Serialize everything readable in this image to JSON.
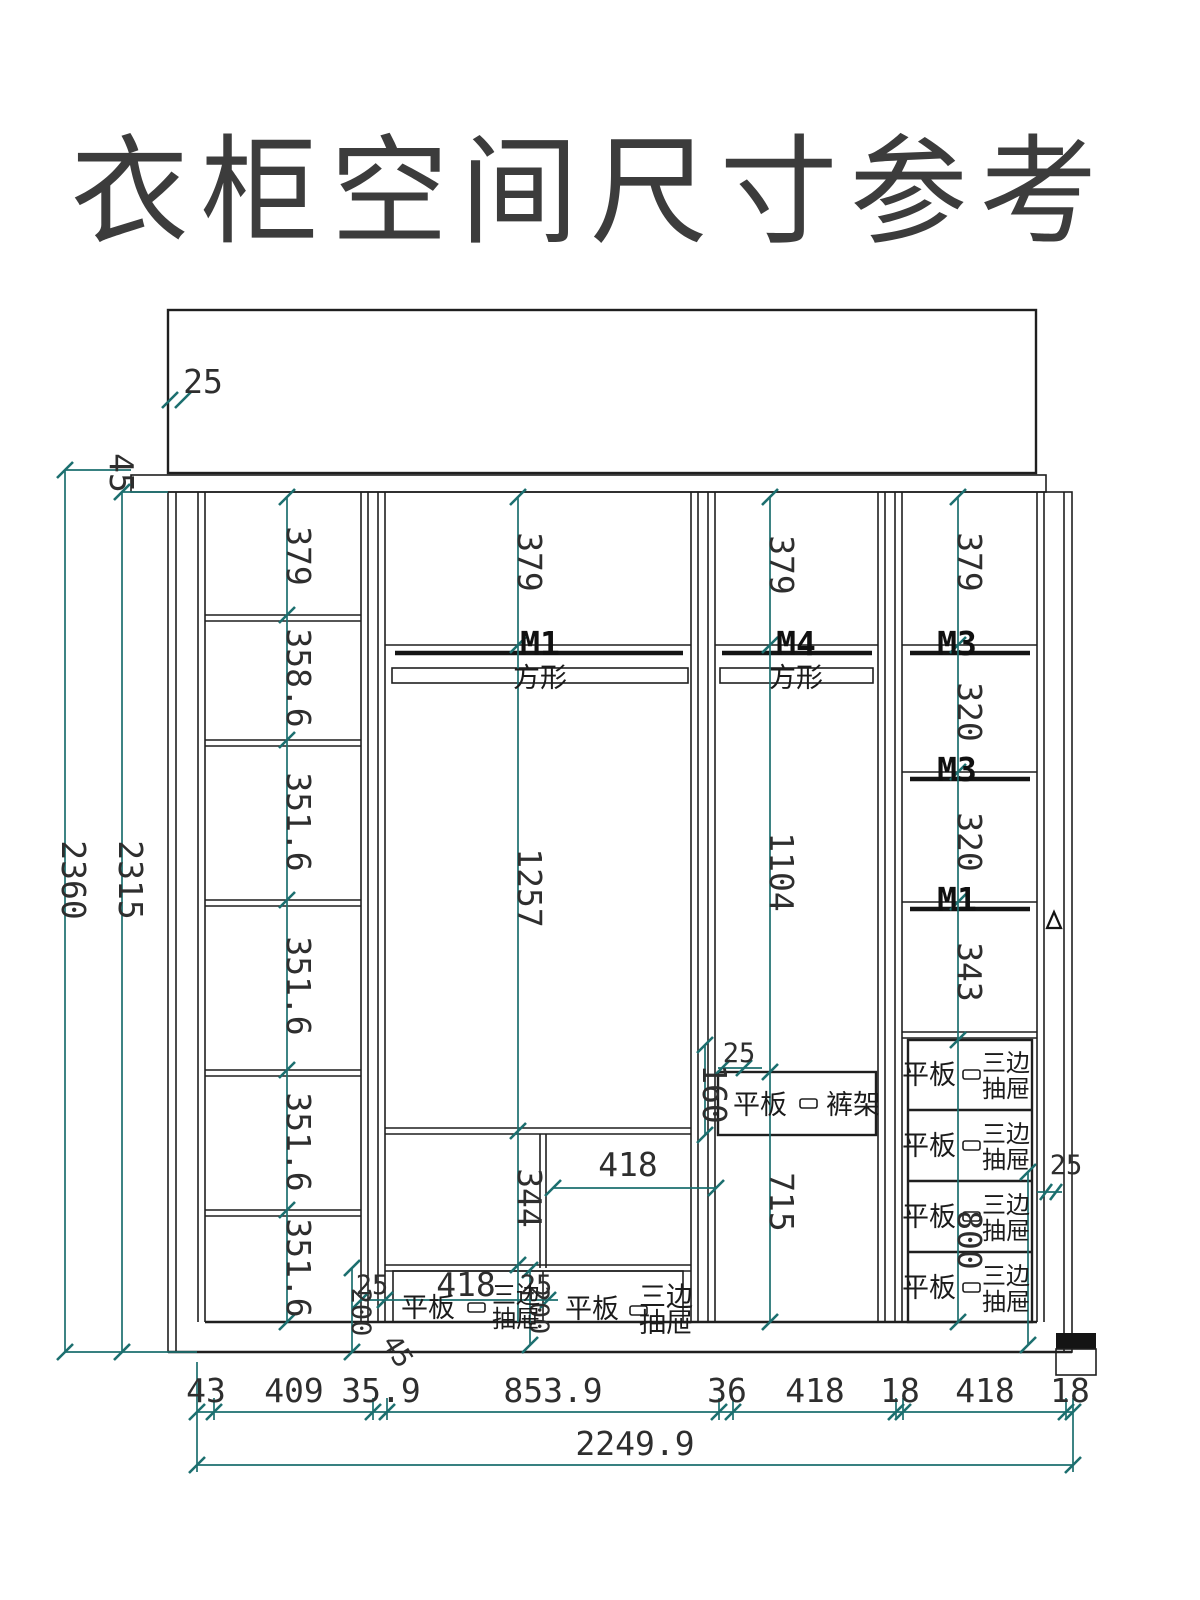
{
  "title": "衣柜空间尺寸参考",
  "labels": {
    "flat_board": "平板",
    "three_side_1": "三边",
    "three_side_2": "抽屉",
    "trouser_rack": "裤架",
    "square_rod": "方形",
    "triangle_marker": "△"
  },
  "m_labels": {
    "col2": "M1",
    "col3": "M4",
    "col4_top": "M3",
    "col4_mid": "M3",
    "col4_low": "M1"
  },
  "dims": {
    "top_thickness": "25",
    "crown_offset": "45",
    "total_height": "2360",
    "body_height": "2315",
    "col1_cells": [
      "379",
      "358.6",
      "351.6",
      "351.6",
      "351.6",
      "351.6"
    ],
    "col2": {
      "top": "379",
      "hang": "1257",
      "lower_left": "344",
      "lower_right_width": "418",
      "d_left": "25",
      "d_width": "418",
      "d_right": "25",
      "d_h1": "200",
      "d_h2": "200",
      "base": "45"
    },
    "col3": {
      "top": "379",
      "hang": "1104",
      "gap": "25",
      "rack_height": "160",
      "lower": "715"
    },
    "col4": {
      "top": "379",
      "cell1": "320",
      "cell2": "320",
      "cell3": "343",
      "drawer_total": "800",
      "gap": "25"
    },
    "bottom_row": [
      "43",
      "409",
      "35.9",
      "853.9",
      "36",
      "418",
      "18",
      "418",
      "18"
    ],
    "total_width": "2249.9"
  },
  "colors": {
    "dim_line": "#1c6f6f",
    "outline": "#1f1f1f",
    "rod": "#d2c7b2",
    "handle": "#d4aa55",
    "cabinet_fill": "#f4f4f2",
    "title": "#3c3c3c"
  }
}
